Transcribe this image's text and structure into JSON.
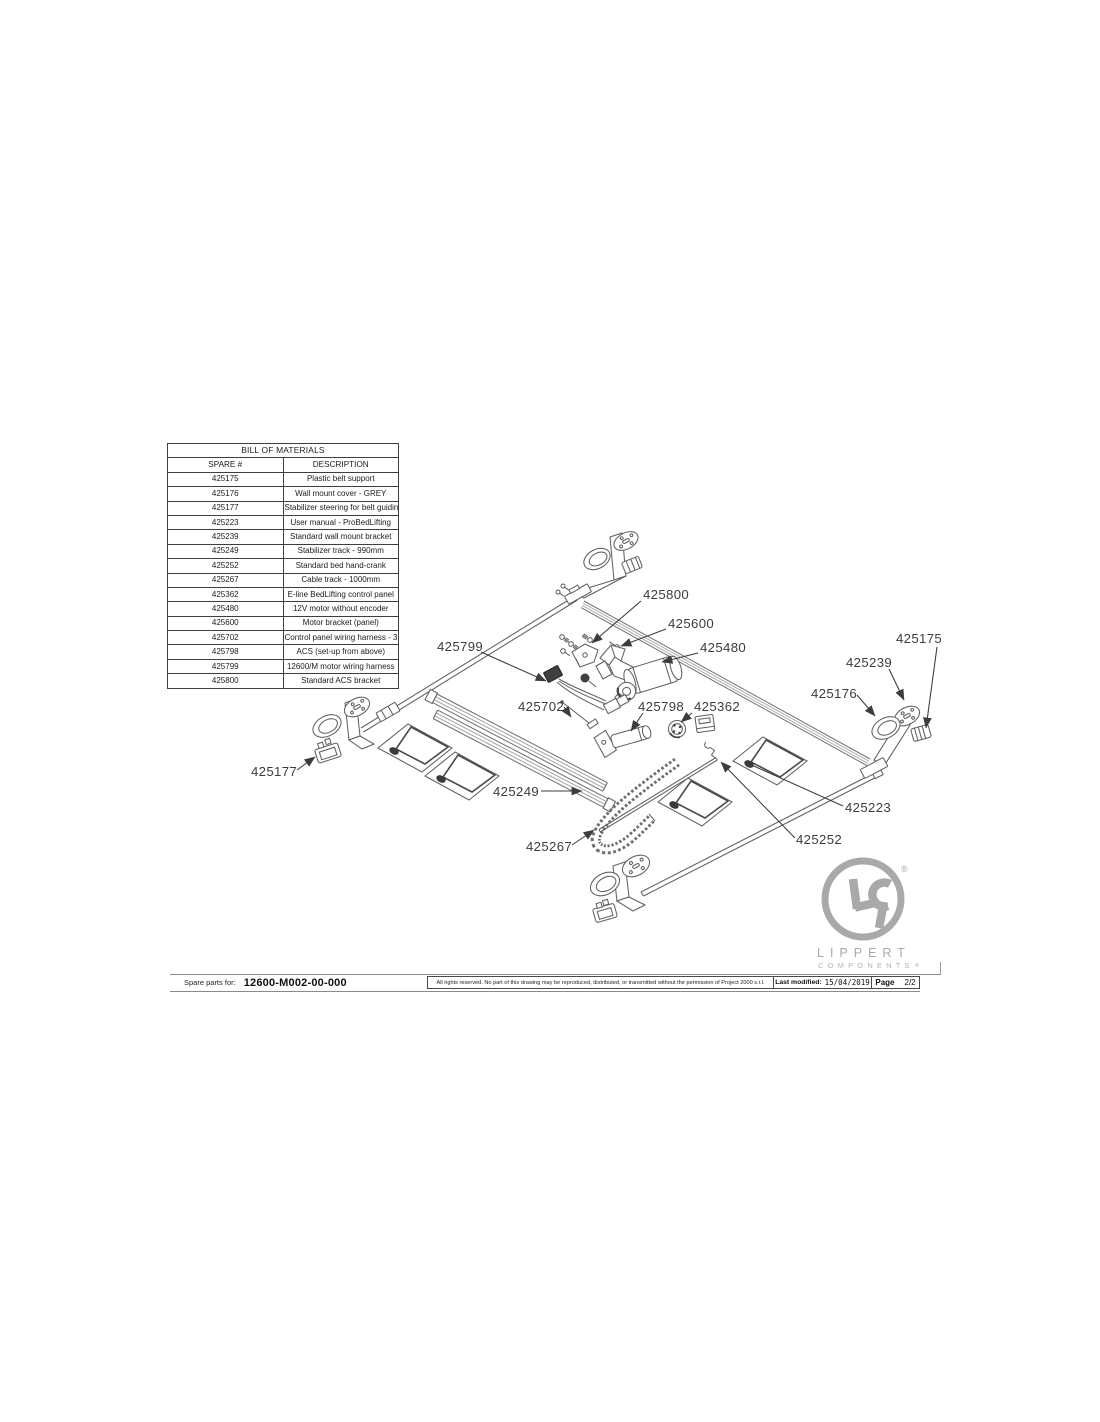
{
  "bom": {
    "title": "BILL OF MATERIALS",
    "columns": {
      "spare": "SPARE #",
      "description": "DESCRIPTION"
    },
    "rows": [
      {
        "spare": "425175",
        "description": "Plastic belt support"
      },
      {
        "spare": "425176",
        "description": "Wall mount cover - GREY"
      },
      {
        "spare": "425177",
        "description": "Stabilizer steering for belt guiding trolley"
      },
      {
        "spare": "425223",
        "description": "User manual - ProBedLifting"
      },
      {
        "spare": "425239",
        "description": "Standard wall mount bracket"
      },
      {
        "spare": "425249",
        "description": "Stabilizer track - 990mm"
      },
      {
        "spare": "425252",
        "description": "Standard bed hand-crank"
      },
      {
        "spare": "425267",
        "description": "Cable track - 1000mm"
      },
      {
        "spare": "425362",
        "description": "E-line BedLifting control panel"
      },
      {
        "spare": "425480",
        "description": "12V motor without encoder"
      },
      {
        "spare": "425600",
        "description": "Motor bracket (panel)"
      },
      {
        "spare": "425702",
        "description": "Control panel wiring harness - 3m"
      },
      {
        "spare": "425798",
        "description": "ACS (set-up from above)"
      },
      {
        "spare": "425799",
        "description": "12600/M motor wiring harness"
      },
      {
        "spare": "425800",
        "description": "Standard ACS bracket"
      }
    ]
  },
  "callouts": [
    "425800",
    "425600",
    "425480",
    "425175",
    "425239",
    "425176",
    "425799",
    "425702",
    "425798",
    "425362",
    "425177",
    "425249",
    "425223",
    "425252",
    "425267"
  ],
  "logo": {
    "name": "LIPPERT",
    "subtitle": "COMPONENTS",
    "registered": "®"
  },
  "footer": {
    "spare_parts_label": "Spare parts for:",
    "drawing_number": "12600-M002-00-000",
    "rights_notice": "All rights reserved. No part of this drawing may be reproduced, distributed, or transmitted without the permission of Project 2000 s.r.l.",
    "last_modified_label": "Last modified:",
    "last_modified_value": "15/04/2019",
    "page_label": "Page",
    "page_value": "2/2"
  }
}
